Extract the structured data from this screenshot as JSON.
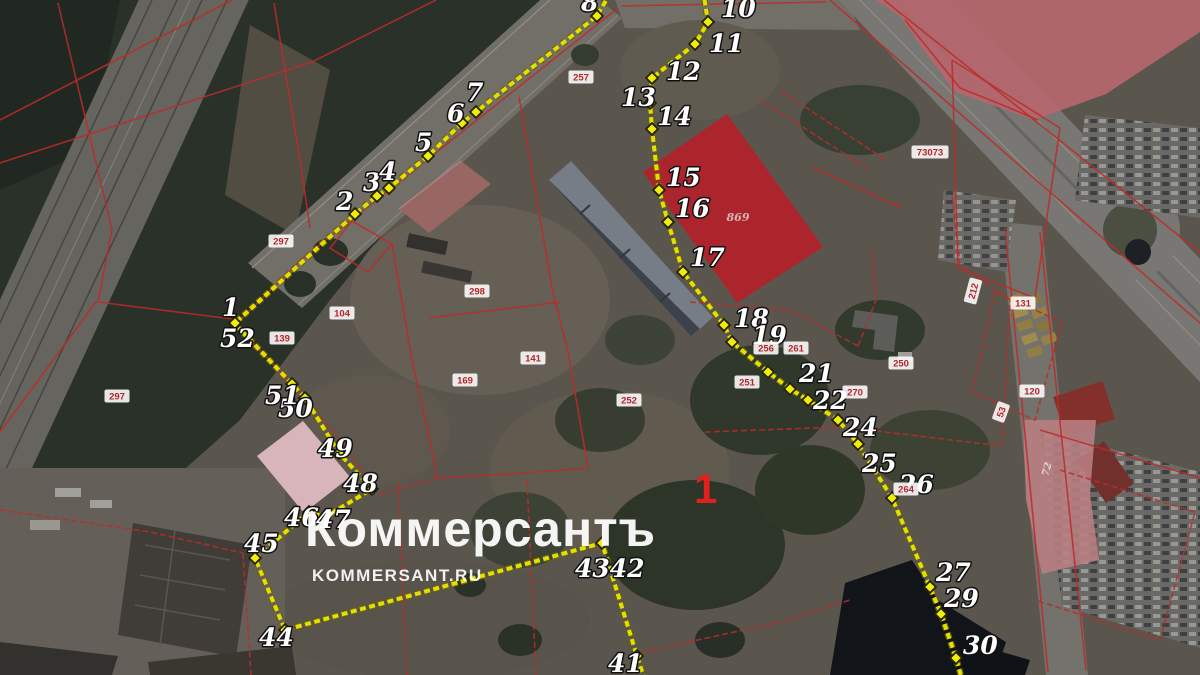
{
  "watermark": {
    "title": "Коммерсантъ",
    "subtitle": "KOMMERSANT.RU"
  },
  "colors": {
    "boundary_line": "#e4de07",
    "boundary_casing": "#6b6400",
    "marker_fill": "#f2ec09",
    "marker_outline": "#23230a",
    "cadastral_line": "#bc2b28",
    "parcel_text": "#b3262a",
    "parcel_box": "rgba(255,255,255,0.88)",
    "area_label": "#e01f1f",
    "red_parcel_fill": "#b2232a",
    "rose_fill": "#b5676e",
    "pink_band_fill": "#b97e82",
    "pink_parcel_fill": "#e3bdc3"
  },
  "map": {
    "area_label": {
      "text": "1",
      "x": 694,
      "y": 503,
      "size": 42
    },
    "zone_labels": [
      {
        "text": "869",
        "x": 738,
        "y": 221,
        "size": 11,
        "rot": 0,
        "color": "#d9b4b4"
      },
      {
        "text": "72",
        "x": 1050,
        "y": 470,
        "size": 10,
        "rot": -75,
        "color": "#e3d6d6"
      }
    ],
    "overlays": [
      {
        "name": "rose-parcel-ne",
        "fill": "#b5676e",
        "opacity": 0.92,
        "points": [
          [
            876,
            0
          ],
          [
            1200,
            0
          ],
          [
            1200,
            32
          ],
          [
            1106,
            94
          ],
          [
            1034,
            120
          ],
          [
            995,
            106
          ],
          [
            955,
            92
          ],
          [
            925,
            52
          ],
          [
            900,
            16
          ]
        ]
      },
      {
        "name": "red-parcel",
        "fill": "#b2232a",
        "opacity": 0.95,
        "points": [
          [
            727,
            114
          ],
          [
            823,
            247
          ],
          [
            737,
            303
          ],
          [
            643,
            172
          ]
        ]
      },
      {
        "name": "pink-parcel-sw",
        "fill": "#e3bdc3",
        "opacity": 0.92,
        "points": [
          [
            303,
            421
          ],
          [
            350,
            477
          ],
          [
            304,
            513
          ],
          [
            257,
            456
          ]
        ]
      },
      {
        "name": "pink-band-se",
        "fill": "#b97e82",
        "opacity": 0.88,
        "points": [
          [
            1023,
            420
          ],
          [
            1096,
            420
          ],
          [
            1090,
            494
          ],
          [
            1099,
            560
          ],
          [
            1042,
            574
          ],
          [
            1026,
            500
          ]
        ]
      }
    ],
    "cadastral_lines": [
      {
        "pts": [
          [
            302,
            259
          ],
          [
            618,
            8
          ]
        ]
      },
      {
        "pts": [
          [
            240,
            320
          ],
          [
            302,
            259
          ]
        ]
      },
      {
        "pts": [
          [
            352,
            221
          ],
          [
            392,
            244
          ],
          [
            368,
            272
          ],
          [
            330,
            248
          ],
          [
            352,
            221
          ]
        ]
      },
      {
        "pts": [
          [
            392,
            244
          ],
          [
            412,
            360
          ],
          [
            438,
            478
          ]
        ]
      },
      {
        "pts": [
          [
            438,
            478
          ],
          [
            512,
            474
          ],
          [
            588,
            468
          ]
        ]
      },
      {
        "pts": [
          [
            519,
            97
          ],
          [
            552,
            288
          ],
          [
            568,
            352
          ],
          [
            588,
            468
          ]
        ]
      },
      {
        "pts": [
          [
            430,
            318
          ],
          [
            560,
            302
          ]
        ]
      },
      {
        "pts": [
          [
            246,
            336
          ],
          [
            300,
            392
          ],
          [
            335,
            434
          ],
          [
            380,
            494
          ]
        ],
        "dash": true
      },
      {
        "pts": [
          [
            380,
            494
          ],
          [
            438,
            478
          ]
        ],
        "dash": true
      },
      {
        "pts": [
          [
            398,
            482
          ],
          [
            407,
            675
          ]
        ],
        "dash": true
      },
      {
        "pts": [
          [
            527,
            480
          ],
          [
            536,
            675
          ]
        ],
        "dash": true
      },
      {
        "pts": [
          [
            243,
            553
          ],
          [
            251,
            675
          ]
        ],
        "dash": true
      },
      {
        "pts": [
          [
            0,
            510
          ],
          [
            150,
            532
          ],
          [
            243,
            553
          ]
        ],
        "dash": true
      },
      {
        "pts": [
          [
            58,
            3
          ],
          [
            112,
            230
          ],
          [
            98,
            302
          ],
          [
            240,
            320
          ]
        ]
      },
      {
        "pts": [
          [
            0,
            120
          ],
          [
            232,
            0
          ]
        ]
      },
      {
        "pts": [
          [
            0,
            163
          ],
          [
            312,
            62
          ],
          [
            436,
            0
          ]
        ]
      },
      {
        "pts": [
          [
            274,
            3
          ],
          [
            300,
            160
          ],
          [
            310,
            228
          ]
        ]
      },
      {
        "pts": [
          [
            690,
            302
          ],
          [
            790,
            310
          ],
          [
            858,
            346
          ]
        ],
        "dash": true
      },
      {
        "pts": [
          [
            858,
            346
          ],
          [
            876,
            300
          ],
          [
            872,
            252
          ]
        ],
        "dash": true
      },
      {
        "pts": [
          [
            705,
            432
          ],
          [
            842,
            427
          ],
          [
            1002,
            446
          ]
        ],
        "dash": true
      },
      {
        "pts": [
          [
            1002,
            446
          ],
          [
            1010,
            300
          ],
          [
            960,
            265
          ],
          [
            952,
            195
          ]
        ],
        "dash": true
      },
      {
        "pts": [
          [
            830,
            0
          ],
          [
            1208,
            330
          ]
        ]
      },
      {
        "pts": [
          [
            884,
            0
          ],
          [
            1212,
            262
          ]
        ]
      },
      {
        "pts": [
          [
            952,
            60
          ],
          [
            1060,
            128
          ],
          [
            1035,
            298
          ],
          [
            958,
            268
          ],
          [
            952,
            60
          ]
        ]
      },
      {
        "pts": [
          [
            995,
            292
          ],
          [
            1062,
            322
          ],
          [
            1035,
            420
          ],
          [
            972,
            392
          ],
          [
            995,
            292
          ]
        ],
        "dash": true
      },
      {
        "pts": [
          [
            1040,
            430
          ],
          [
            1200,
            478
          ]
        ]
      },
      {
        "pts": [
          [
            1060,
            470
          ],
          [
            1195,
            512
          ],
          [
            1160,
            640
          ],
          [
            1035,
            600
          ]
        ],
        "dash": true
      },
      {
        "pts": [
          [
            757,
            98
          ],
          [
            870,
            170
          ]
        ],
        "dash": true
      },
      {
        "pts": [
          [
            782,
            92
          ],
          [
            886,
            160
          ]
        ],
        "dash": true
      },
      {
        "pts": [
          [
            814,
            168
          ],
          [
            902,
            208
          ]
        ]
      },
      {
        "pts": [
          [
            643,
            652
          ],
          [
            780,
            622
          ],
          [
            850,
            600
          ]
        ],
        "dash": true
      },
      {
        "pts": [
          [
            1005,
            228
          ],
          [
            1048,
            672
          ]
        ]
      },
      {
        "pts": [
          [
            1040,
            232
          ],
          [
            1086,
            670
          ]
        ]
      },
      {
        "pts": [
          [
            905,
            20
          ],
          [
            960,
            88
          ],
          [
            1000,
            104
          ],
          [
            1038,
            120
          ]
        ]
      },
      {
        "pts": [
          [
            622,
            6
          ],
          [
            826,
            2
          ]
        ]
      },
      {
        "pts": [
          [
            0,
            432
          ],
          [
            96,
            302
          ]
        ]
      }
    ],
    "parcel_labels": [
      {
        "text": "297",
        "x": 281,
        "y": 241
      },
      {
        "text": "257",
        "x": 581,
        "y": 77
      },
      {
        "text": "297",
        "x": 117,
        "y": 396
      },
      {
        "text": "298",
        "x": 477,
        "y": 291
      },
      {
        "text": "104",
        "x": 342,
        "y": 313
      },
      {
        "text": "139",
        "x": 282,
        "y": 338
      },
      {
        "text": "141",
        "x": 533,
        "y": 358
      },
      {
        "text": "169",
        "x": 465,
        "y": 380
      },
      {
        "text": "252",
        "x": 629,
        "y": 400
      },
      {
        "text": "251",
        "x": 747,
        "y": 382
      },
      {
        "text": "256",
        "x": 766,
        "y": 348
      },
      {
        "text": "261",
        "x": 796,
        "y": 348
      },
      {
        "text": "270",
        "x": 855,
        "y": 392
      },
      {
        "text": "250",
        "x": 901,
        "y": 363
      },
      {
        "text": "264",
        "x": 906,
        "y": 489
      },
      {
        "text": "131",
        "x": 1023,
        "y": 303
      },
      {
        "text": "120",
        "x": 1032,
        "y": 391
      },
      {
        "text": "53",
        "x": 1001,
        "y": 412,
        "rot": -70
      },
      {
        "text": "212",
        "x": 973,
        "y": 291,
        "rot": -75
      },
      {
        "text": "73073",
        "x": 930,
        "y": 152
      }
    ],
    "boundary": {
      "chains": [
        {
          "name": "south-west-chain",
          "points": [
            {
              "n": "",
              "x": 648,
              "y": 690,
              "lead": true
            },
            {
              "n": "41",
              "x": 637,
              "y": 656,
              "lx": 608,
              "ly": 672
            },
            {
              "n": "4342",
              "x": 602,
              "y": 543,
              "lx": 575,
              "ly": 577
            },
            {
              "n": "44",
              "x": 285,
              "y": 630,
              "lx": 259,
              "ly": 646
            },
            {
              "n": "45",
              "x": 255,
              "y": 558,
              "lx": 244,
              "ly": 552
            },
            {
              "n": "46",
              "x": 309,
              "y": 512,
              "lx": 284,
              "ly": 526
            },
            {
              "n": "47",
              "x": 325,
              "y": 517,
              "lx": 316,
              "ly": 528
            },
            {
              "n": "48",
              "x": 372,
              "y": 489,
              "lx": 343,
              "ly": 492
            },
            {
              "n": "49",
              "x": 339,
              "y": 453,
              "lx": 318,
              "ly": 457
            },
            {
              "n": "50",
              "x": 305,
              "y": 398,
              "lx": 278,
              "ly": 417
            },
            {
              "n": "51",
              "x": 292,
              "y": 384,
              "lx": 265,
              "ly": 404
            },
            {
              "n": "52",
              "x": 235,
              "y": 324,
              "lx": 220,
              "ly": 347
            },
            {
              "n": "1",
              "x": 235,
              "y": 323,
              "lx": 222,
              "ly": 316
            },
            {
              "n": "2",
              "x": 355,
              "y": 214,
              "lx": 336,
              "ly": 210
            },
            {
              "n": "3",
              "x": 377,
              "y": 196,
              "lx": 363,
              "ly": 191
            },
            {
              "n": "4",
              "x": 389,
              "y": 188,
              "lx": 379,
              "ly": 180
            },
            {
              "n": "5",
              "x": 428,
              "y": 156,
              "lx": 415,
              "ly": 151
            },
            {
              "n": "6",
              "x": 462,
              "y": 123,
              "lx": 447,
              "ly": 122
            },
            {
              "n": "7",
              "x": 476,
              "y": 112,
              "lx": 466,
              "ly": 101
            },
            {
              "n": "8",
              "x": 597,
              "y": 16,
              "lx": 581,
              "ly": 11
            },
            {
              "n": "",
              "x": 612,
              "y": -10,
              "lead": true
            }
          ]
        },
        {
          "name": "north-east-chain",
          "points": [
            {
              "n": "",
              "x": 703,
              "y": -10,
              "lead": true
            },
            {
              "n": "10",
              "x": 708,
              "y": 22,
              "lx": 721,
              "ly": 17
            },
            {
              "n": "11",
              "x": 695,
              "y": 44,
              "lx": 709,
              "ly": 52
            },
            {
              "n": "12",
              "x": 652,
              "y": 78,
              "lx": 666,
              "ly": 80
            },
            {
              "n": "13",
              "x": 650,
              "y": 103,
              "lx": 621,
              "ly": 106
            },
            {
              "n": "14",
              "x": 652,
              "y": 129,
              "lx": 657,
              "ly": 125
            },
            {
              "n": "15",
              "x": 659,
              "y": 190,
              "lx": 666,
              "ly": 186
            },
            {
              "n": "16",
              "x": 668,
              "y": 222,
              "lx": 675,
              "ly": 217
            },
            {
              "n": "17",
              "x": 683,
              "y": 272,
              "lx": 690,
              "ly": 266
            },
            {
              "n": "18",
              "x": 724,
              "y": 325,
              "lx": 734,
              "ly": 327
            },
            {
              "n": "19",
              "x": 732,
              "y": 342,
              "lx": 752,
              "ly": 344
            },
            {
              "n": "",
              "x": 768,
              "y": 372
            },
            {
              "n": "21",
              "x": 790,
              "y": 389,
              "lx": 799,
              "ly": 382
            },
            {
              "n": "22",
              "x": 808,
              "y": 400,
              "lx": 813,
              "ly": 409
            },
            {
              "n": "24",
              "x": 838,
              "y": 420,
              "lx": 843,
              "ly": 436
            },
            {
              "n": "25",
              "x": 858,
              "y": 444,
              "lx": 862,
              "ly": 472
            },
            {
              "n": "26",
              "x": 892,
              "y": 498,
              "lx": 899,
              "ly": 493
            },
            {
              "n": "27",
              "x": 930,
              "y": 587,
              "lx": 936,
              "ly": 581
            },
            {
              "n": "29",
              "x": 941,
              "y": 614,
              "lx": 944,
              "ly": 607
            },
            {
              "n": "30",
              "x": 956,
              "y": 658,
              "lx": 963,
              "ly": 654
            },
            {
              "n": "",
              "x": 965,
              "y": 690,
              "lead": true
            }
          ]
        }
      ]
    }
  }
}
